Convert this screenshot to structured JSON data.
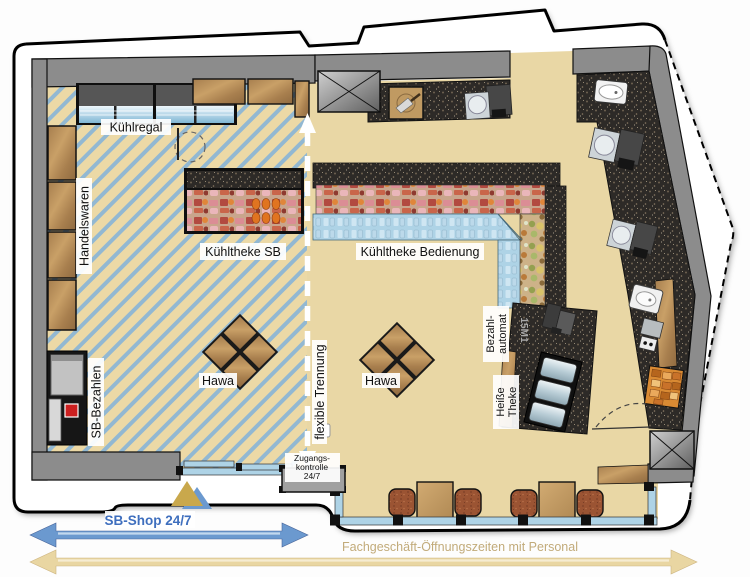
{
  "title": "Shop floor plan – SB-Shop / Fachgeschäft",
  "labels": {
    "kuehlregal": "Kühlregal",
    "handelswaren": "Handelswaren",
    "kuehltheke_sb": "Kühltheke SB",
    "kuehltheke_bedienung": "Kühltheke Bedienung",
    "hawa_left": "Hawa",
    "hawa_right": "Hawa",
    "sb_bezahlen": "SB-Bezahlen",
    "flexible_trennung": "flexible Trennung",
    "bezahl_automat": {
      "line1": "Bezahl-",
      "line2": "automat"
    },
    "heisse_theke": {
      "line1": "Heiße",
      "line2": "Theke"
    },
    "counter_code": "15M1",
    "zugangskontrolle": {
      "line1": "Zugangs-",
      "line2": "kontrolle",
      "line3": "24/7"
    }
  },
  "zones": {
    "sb_shop": {
      "label": "SB-Shop 24/7",
      "text_color": "#3f6fbe",
      "arrow_color": "#6b99cf",
      "floor_style": "beige with blue diagonal hatching"
    },
    "fachgeschaeft": {
      "label": "Fachgeschäft-Öffnungszeiten mit Personal",
      "text_color": "#c2ab7a",
      "arrow_color": "#ead7a2",
      "floor_style": "plain beige"
    }
  },
  "icons": {
    "entrance_marker": "gold-blue triangle",
    "access_card_reader": "card-reader",
    "shaft_top": "x-cross-box",
    "shaft_bottom": "x-cross-box",
    "partition_arrow": "white dashed double arrow",
    "entry_arrow": "white down arrow"
  },
  "colors": {
    "floor_beige": "#e9d7a5",
    "hatch_blue": "#92b8d2",
    "wall_gray": "#8c8c8c",
    "counter_dark": "#2d2a27",
    "glass_blue": "#aed3e6",
    "wood": "#b98e5c",
    "kiosk_red_button": "#cc1f1f"
  }
}
